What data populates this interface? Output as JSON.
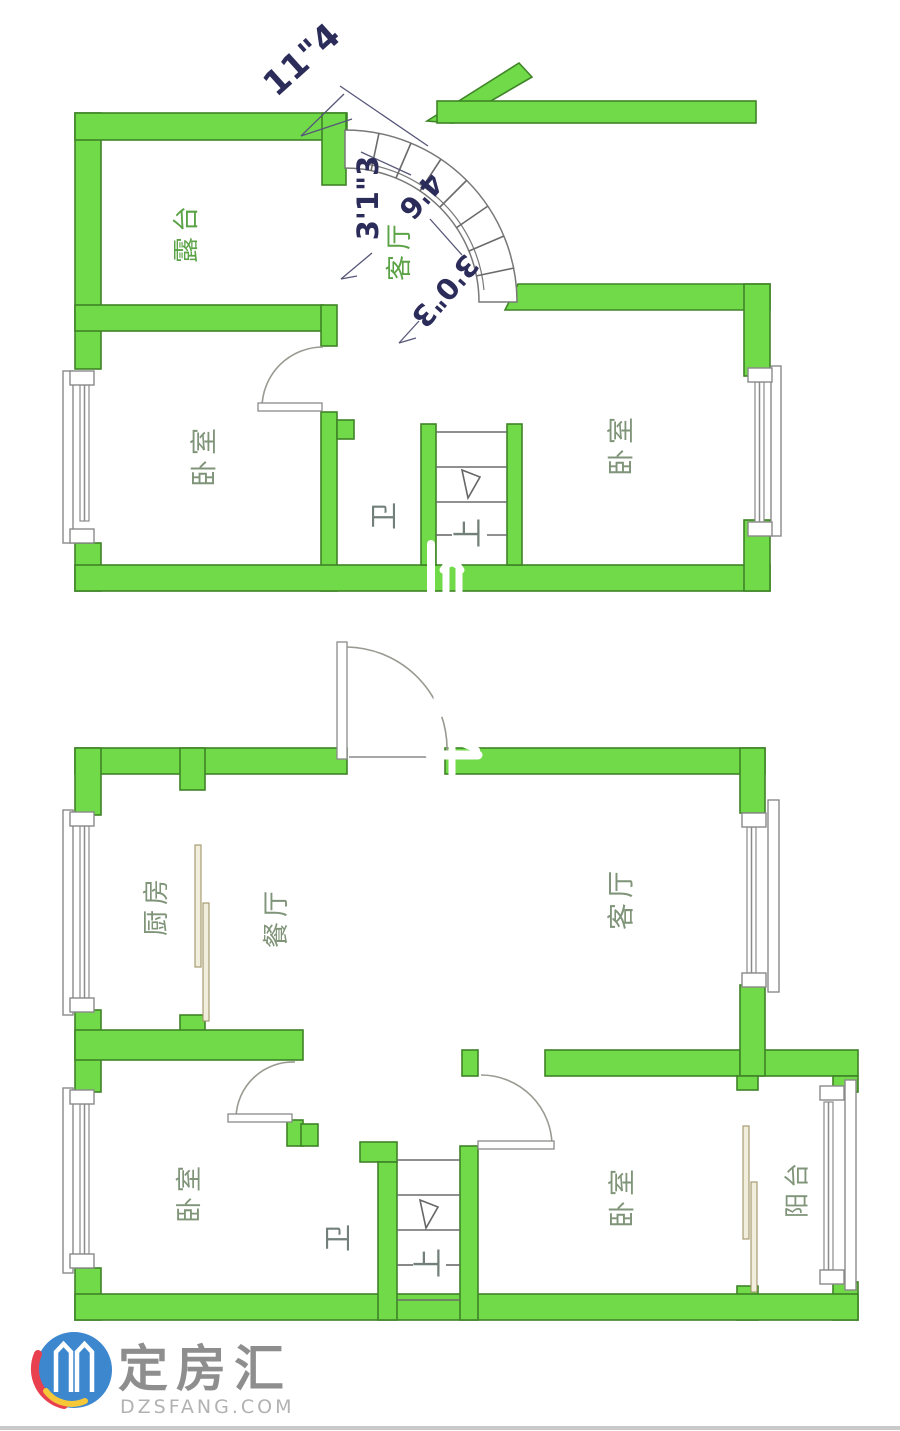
{
  "branding": {
    "name": "定房汇",
    "domain": "DZSFANG.COM"
  },
  "colors": {
    "wall_fill": "#70da48",
    "wall_stroke": "#3f8427",
    "room_label": "#7f9478",
    "room_label_green": "#5ca348",
    "util_label": "#73807a",
    "dim_text": "#2c2c5a",
    "door_panel": "#f2eedd",
    "logo_blue": "#3d87cf",
    "logo_red": "#e8404e",
    "logo_yellow": "#f6c838",
    "logo_text": "#8e8e8e",
    "logo_domain": "#b2b2b2"
  },
  "upper_floor": {
    "rooms": {
      "terrace": "露台",
      "bedroom_left": "卧室",
      "bathroom": "卫",
      "bedroom_right": "卧室",
      "living": "客厅"
    },
    "stairs": {
      "label": "上"
    },
    "dimensions": {
      "d1": "11\"4",
      "d2": "3'1\"3",
      "d3": "4'6",
      "d4": "3'0\"3"
    }
  },
  "lower_floor": {
    "rooms": {
      "kitchen": "厨房",
      "dining": "餐厅",
      "living": "客厅",
      "bedroom_left": "卧室",
      "bathroom": "卫",
      "bedroom_right": "卧室",
      "balcony": "阳台"
    },
    "stairs": {
      "label": "上"
    }
  }
}
